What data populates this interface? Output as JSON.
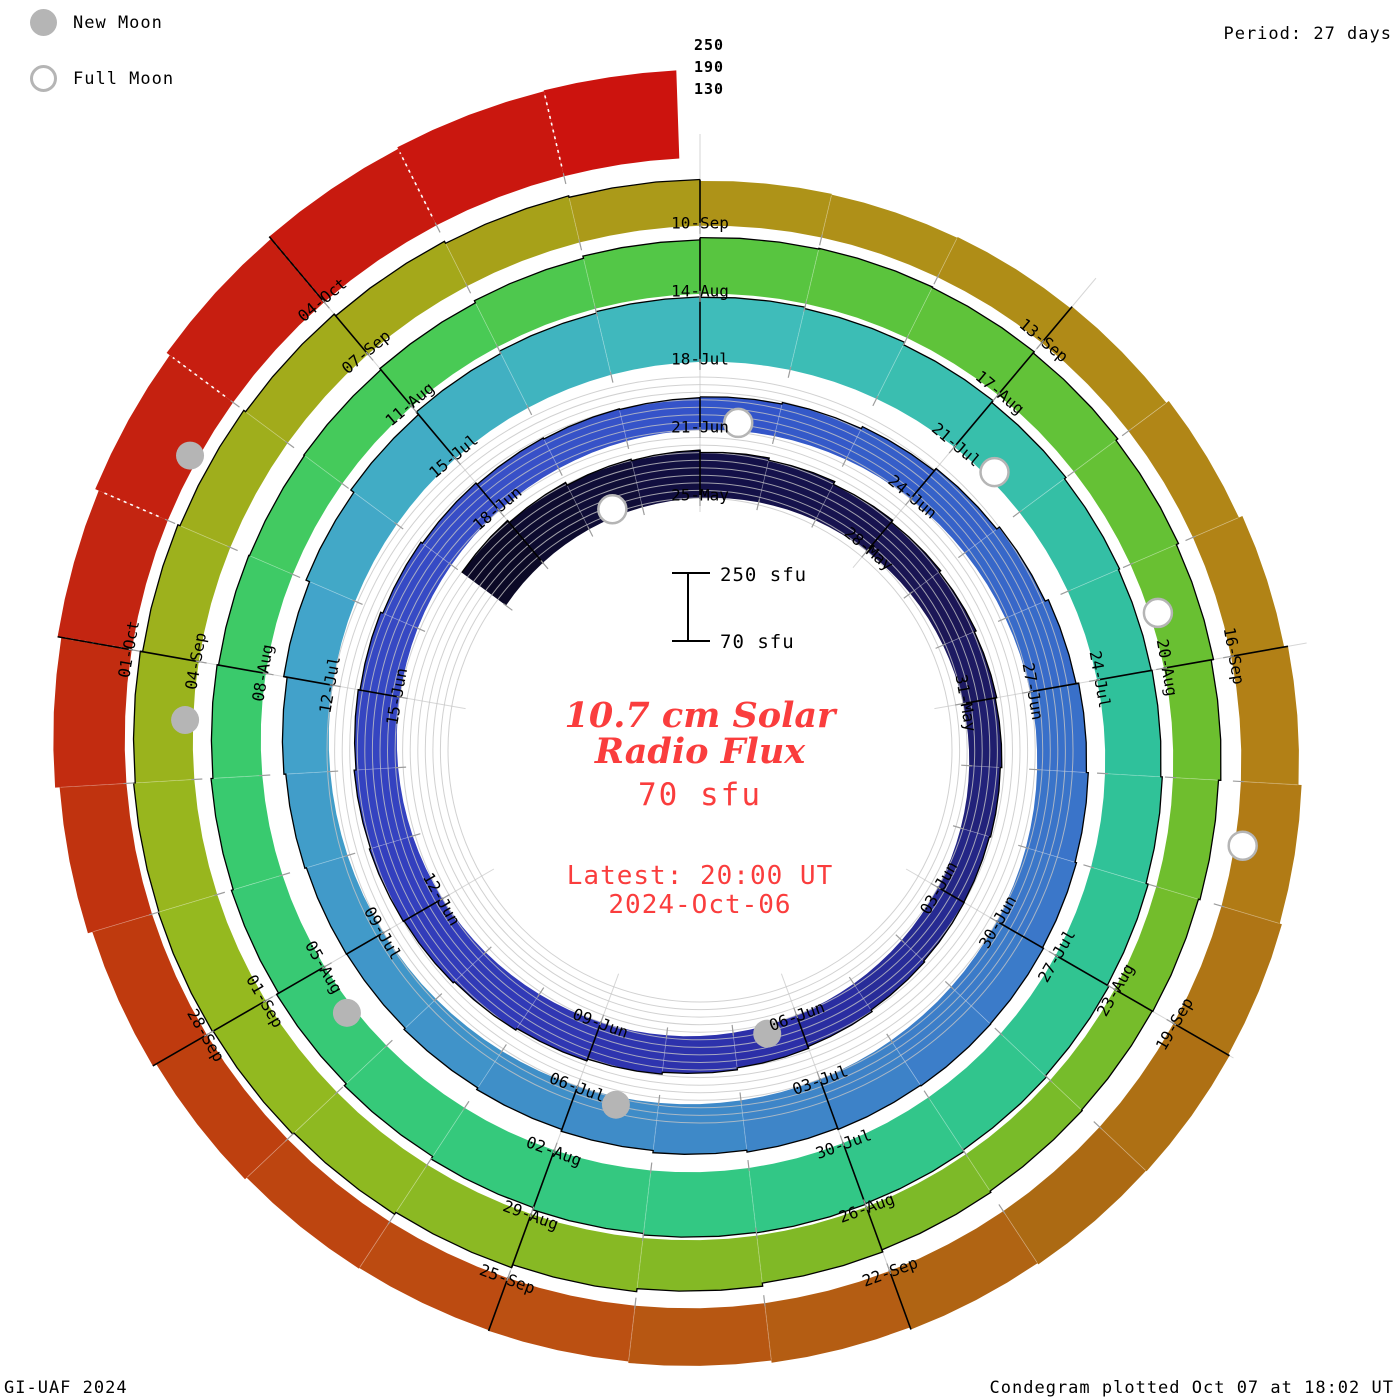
{
  "legend": {
    "new_moon_label": "New Moon",
    "full_moon_label": "Full Moon"
  },
  "header": {
    "period_label": "Period: 27 days"
  },
  "footer": {
    "left": "GI-UAF 2024",
    "right": "Condegram plotted Oct 07 at 18:02 UT"
  },
  "chart_data": {
    "type": "spiral-bar-condegram",
    "period_days": 27,
    "flux_base_sfu": 70,
    "flux_gridlines_sfu": [
      130,
      190,
      250
    ],
    "flux_tick_labels": [
      "250",
      "190",
      "130"
    ],
    "date_label_interval_days": 3,
    "latest_day_fraction": 0.85,
    "annotations": {
      "scale_top_label": "250 sfu",
      "scale_bottom_label": "70 sfu",
      "title_line1": "10.7 cm Solar",
      "title_line2": "Radio Flux",
      "subtitle": "70 sfu",
      "latest_line1": "Latest: 20:00 UT",
      "latest_line2": "2024-Oct-06"
    },
    "moons": {
      "new": [
        "06-Jun",
        "05-Jul",
        "04-Aug",
        "03-Sep",
        "02-Oct"
      ],
      "full": [
        "23-May",
        "21-Jun",
        "21-Jul",
        "19-Aug",
        "17-Sep"
      ]
    },
    "colors": {
      "grid": "#c6c6c6",
      "radial_grid": "#c6c6c6",
      "day_tick": "#9c9c9c",
      "label_text": "#000000",
      "moon_gray": "#b5b5b5",
      "skyline": "#000000",
      "annotation_red": "#fa3d3d",
      "background": "#ffffff"
    },
    "color_stops": [
      [
        0,
        "#0b0926"
      ],
      [
        4,
        "#131048"
      ],
      [
        8,
        "#1b1656"
      ],
      [
        13,
        "#262a92"
      ],
      [
        16,
        "#2c2fa8"
      ],
      [
        22,
        "#333fbe"
      ],
      [
        28,
        "#3850c8"
      ],
      [
        31,
        "#3355c9"
      ],
      [
        38,
        "#3a74c9"
      ],
      [
        45,
        "#3f8cc8"
      ],
      [
        52,
        "#42a4ca"
      ],
      [
        58,
        "#3fbcba"
      ],
      [
        64,
        "#2fc19b"
      ],
      [
        71,
        "#33c883"
      ],
      [
        78,
        "#3aca6c"
      ],
      [
        82,
        "#49ca55"
      ],
      [
        85,
        "#58c540"
      ],
      [
        91,
        "#6cbf2f"
      ],
      [
        97,
        "#80b926"
      ],
      [
        103,
        "#95b91f"
      ],
      [
        109,
        "#a4a81a"
      ],
      [
        112,
        "#ae9318"
      ],
      [
        118,
        "#b28016"
      ],
      [
        122,
        "#ac6a13"
      ],
      [
        126,
        "#bb5012"
      ],
      [
        130,
        "#bf3a0e"
      ],
      [
        133,
        "#c32511"
      ],
      [
        138,
        "#cc130e"
      ]
    ],
    "series": [
      [
        "21-May",
        215
      ],
      [
        "22-May",
        208
      ],
      [
        "23-May",
        200
      ],
      [
        "24-May",
        196
      ],
      [
        "25-May",
        190
      ],
      [
        "26-May",
        184
      ],
      [
        "27-May",
        176
      ],
      [
        "28-May",
        170
      ],
      [
        "29-May",
        165
      ],
      [
        "30-May",
        160
      ],
      [
        "31-May",
        156
      ],
      [
        "01-Jun",
        152
      ],
      [
        "02-Jun",
        149
      ],
      [
        "03-Jun",
        150
      ],
      [
        "04-Jun",
        153
      ],
      [
        "05-Jun",
        158
      ],
      [
        "06-Jun",
        163
      ],
      [
        "07-Jun",
        168
      ],
      [
        "08-Jun",
        173
      ],
      [
        "09-Jun",
        178
      ],
      [
        "10-Jun",
        183
      ],
      [
        "11-Jun",
        187
      ],
      [
        "12-Jun",
        189
      ],
      [
        "13-Jun",
        186
      ],
      [
        "14-Jun",
        181
      ],
      [
        "15-Jun",
        176
      ],
      [
        "16-Jun",
        170
      ],
      [
        "17-Jun",
        165
      ],
      [
        "18-Jun",
        160
      ],
      [
        "19-Jun",
        157
      ],
      [
        "20-Jun",
        155
      ],
      [
        "21-Jun",
        157
      ],
      [
        "22-Jun",
        161
      ],
      [
        "23-Jun",
        167
      ],
      [
        "24-Jun",
        175
      ],
      [
        "25-Jun",
        184
      ],
      [
        "26-Jun",
        193
      ],
      [
        "27-Jun",
        200
      ],
      [
        "28-Jun",
        205
      ],
      [
        "29-Jun",
        209
      ],
      [
        "30-Jun",
        212
      ],
      [
        "01-Jul",
        213
      ],
      [
        "02-Jul",
        211
      ],
      [
        "03-Jul",
        207
      ],
      [
        "04-Jul",
        202
      ],
      [
        "05-Jul",
        196
      ],
      [
        "06-Jul",
        191
      ],
      [
        "07-Jul",
        186
      ],
      [
        "08-Jul",
        182
      ],
      [
        "09-Jul",
        183
      ],
      [
        "10-Jul",
        187
      ],
      [
        "11-Jul",
        192
      ],
      [
        "12-Jul",
        201
      ],
      [
        "13-Jul",
        211
      ],
      [
        "14-Jul",
        221
      ],
      [
        "15-Jul",
        230
      ],
      [
        "16-Jul",
        237
      ],
      [
        "17-Jul",
        241
      ],
      [
        "18-Jul",
        240
      ],
      [
        "19-Jul",
        236
      ],
      [
        "20-Jul",
        229
      ],
      [
        "21-Jul",
        223
      ],
      [
        "22-Jul",
        218
      ],
      [
        "23-Jul",
        215
      ],
      [
        "24-Jul",
        217
      ],
      [
        "25-Jul",
        221
      ],
      [
        "26-Jul",
        227
      ],
      [
        "27-Jul",
        232
      ],
      [
        "28-Jul",
        236
      ],
      [
        "29-Jul",
        240
      ],
      [
        "30-Jul",
        242
      ],
      [
        "31-Jul",
        241
      ],
      [
        "01-Aug",
        237
      ],
      [
        "02-Aug",
        231
      ],
      [
        "03-Aug",
        223
      ],
      [
        "04-Aug",
        216
      ],
      [
        "05-Aug",
        210
      ],
      [
        "06-Aug",
        205
      ],
      [
        "07-Aug",
        200
      ],
      [
        "08-Aug",
        196
      ],
      [
        "09-Aug",
        194
      ],
      [
        "10-Aug",
        196
      ],
      [
        "11-Aug",
        200
      ],
      [
        "12-Aug",
        206
      ],
      [
        "13-Aug",
        212
      ],
      [
        "14-Aug",
        218
      ],
      [
        "15-Aug",
        220
      ],
      [
        "16-Aug",
        218
      ],
      [
        "17-Aug",
        214
      ],
      [
        "18-Aug",
        208
      ],
      [
        "19-Aug",
        202
      ],
      [
        "20-Aug",
        196
      ],
      [
        "21-Aug",
        190
      ],
      [
        "22-Aug",
        186
      ],
      [
        "23-Aug",
        184
      ],
      [
        "24-Aug",
        186
      ],
      [
        "25-Aug",
        190
      ],
      [
        "26-Aug",
        196
      ],
      [
        "27-Aug",
        204
      ],
      [
        "28-Aug",
        212
      ],
      [
        "29-Aug",
        220
      ],
      [
        "30-Aug",
        226
      ],
      [
        "31-Aug",
        230
      ],
      [
        "01-Sep",
        232
      ],
      [
        "02-Sep",
        230
      ],
      [
        "03-Sep",
        226
      ],
      [
        "04-Sep",
        220
      ],
      [
        "05-Sep",
        214
      ],
      [
        "06-Sep",
        208
      ],
      [
        "07-Sep",
        202
      ],
      [
        "08-Sep",
        196
      ],
      [
        "09-Sep",
        192
      ],
      [
        "10-Sep",
        188
      ],
      [
        "11-Sep",
        186
      ],
      [
        "12-Sep",
        188
      ],
      [
        "13-Sep",
        194
      ],
      [
        "14-Sep",
        202
      ],
      [
        "15-Sep",
        212
      ],
      [
        "16-Sep",
        222
      ],
      [
        "17-Sep",
        230
      ],
      [
        "18-Sep",
        236
      ],
      [
        "19-Sep",
        240
      ],
      [
        "20-Sep",
        238
      ],
      [
        "21-Sep",
        234
      ],
      [
        "22-Sep",
        228
      ],
      [
        "23-Sep",
        222
      ],
      [
        "24-Sep",
        218
      ],
      [
        "25-Sep",
        216
      ],
      [
        "26-Sep",
        218
      ],
      [
        "27-Sep",
        224
      ],
      [
        "28-Sep",
        234
      ],
      [
        "29-Sep",
        246
      ],
      [
        "30-Sep",
        258
      ],
      [
        "01-Oct",
        268
      ],
      [
        "02-Oct",
        278
      ],
      [
        "03-Oct",
        288
      ],
      [
        "04-Oct",
        295
      ],
      [
        "05-Oct",
        300
      ],
      [
        "06-Oct",
        302
      ]
    ]
  }
}
